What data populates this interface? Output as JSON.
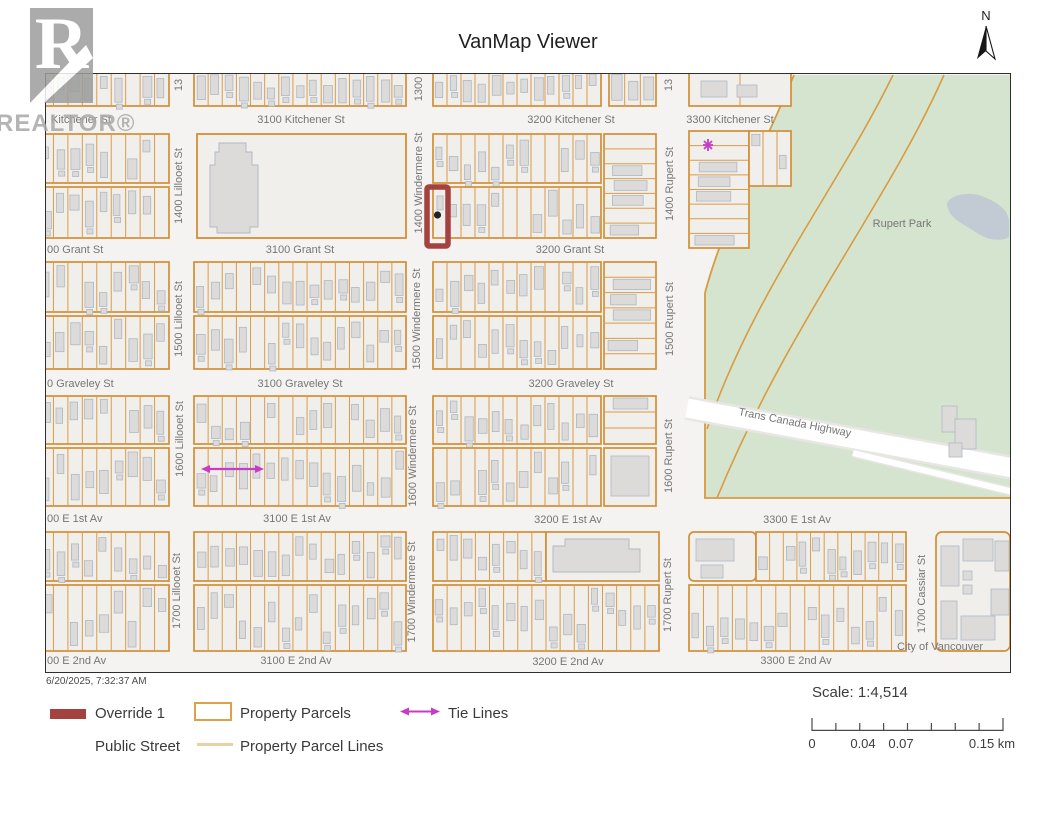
{
  "title": "VanMap Viewer",
  "north": {
    "label": "N"
  },
  "watermark": {
    "letter": "R",
    "name": "REALTOR®"
  },
  "footer": {
    "timestamp": "6/20/2025, 7:32:37 AM",
    "legend": {
      "override_label": "Override 1",
      "property_parcels_label": "Property Parcels",
      "tie_lines_label": "Tie Lines",
      "public_street_label": "Public Street",
      "property_parcel_lines_label": "Property Parcel Lines"
    },
    "scale": {
      "label": "Scale: 1:4,514",
      "tick_labels": [
        "0",
        "0.04",
        "0.07",
        "0.15 km"
      ]
    }
  },
  "colors": {
    "parcel_orange": "#dd9a44",
    "block_outline": "#d28f35",
    "block_fill": "#f1efec",
    "street_bg": "#f4f3f1",
    "override_red": "#a3423f",
    "tie_magenta": "#c73bc7",
    "park_green": "#d5e4cf",
    "park_edge": "#d99b3f",
    "pond_gray": "#c2cbd3",
    "building_fill": "#dcdbda",
    "building_stroke": "#aeb8c3",
    "label_gray": "#767676",
    "legend_line_tan": "#ecd0a4",
    "legend_parcel_border": "#dfa04a"
  },
  "map": {
    "labels": [
      {
        "text": "Kitchener St",
        "x": 50,
        "y": 122,
        "align": "start"
      },
      {
        "text": "3100 Kitchener St",
        "x": 300,
        "y": 122
      },
      {
        "text": "3200 Kitchener St",
        "x": 570,
        "y": 122
      },
      {
        "text": "3300 Kitchener St",
        "x": 729,
        "y": 122
      },
      {
        "text": "00 Grant St",
        "x": 46,
        "y": 252,
        "align": "start"
      },
      {
        "text": "3100 Grant St",
        "x": 299,
        "y": 252
      },
      {
        "text": "3200 Grant St",
        "x": 569,
        "y": 252
      },
      {
        "text": "0 Graveley St",
        "x": 46,
        "y": 386,
        "align": "start"
      },
      {
        "text": "3100 Graveley St",
        "x": 299,
        "y": 386
      },
      {
        "text": "3200 Graveley St",
        "x": 570,
        "y": 386
      },
      {
        "text": "00 E 1st Av",
        "x": 46,
        "y": 521,
        "align": "start"
      },
      {
        "text": "3100 E 1st Av",
        "x": 296,
        "y": 521
      },
      {
        "text": "3200 E 1st Av",
        "x": 567,
        "y": 522
      },
      {
        "text": "3300 E 1st Av",
        "x": 796,
        "y": 522
      },
      {
        "text": "00 E 2nd Av",
        "x": 46,
        "y": 663,
        "align": "start"
      },
      {
        "text": "3100 E 2nd Av",
        "x": 295,
        "y": 663
      },
      {
        "text": "3200 E 2nd Av",
        "x": 567,
        "y": 664
      },
      {
        "text": "3300 E 2nd Av",
        "x": 795,
        "y": 663
      },
      {
        "text": "13",
        "x": 181,
        "y": 84,
        "rot": -90
      },
      {
        "text": "1300",
        "x": 421,
        "y": 88,
        "rot": -90
      },
      {
        "text": "13",
        "x": 671,
        "y": 84,
        "rot": -90
      },
      {
        "text": "1400 Lillooet St",
        "x": 181,
        "y": 185,
        "rot": -90
      },
      {
        "text": "1400 Windermere St",
        "x": 421,
        "y": 182,
        "rot": -90
      },
      {
        "text": "1400 Rupert St",
        "x": 672,
        "y": 183,
        "rot": -90
      },
      {
        "text": "1500 Lillooet St",
        "x": 181,
        "y": 318,
        "rot": -90
      },
      {
        "text": "1500 Windermere St",
        "x": 419,
        "y": 318,
        "rot": -90
      },
      {
        "text": "1500 Rupert St",
        "x": 672,
        "y": 318,
        "rot": -90
      },
      {
        "text": "1600 Lillooet St",
        "x": 182,
        "y": 438,
        "rot": -90
      },
      {
        "text": "1600 Windermere St",
        "x": 415,
        "y": 455,
        "rot": -90
      },
      {
        "text": "1600 Rupert St",
        "x": 671,
        "y": 455,
        "rot": -90
      },
      {
        "text": "1700 Lillooet St",
        "x": 179,
        "y": 590,
        "rot": -90
      },
      {
        "text": "1700 Windermere St",
        "x": 414,
        "y": 591,
        "rot": -90
      },
      {
        "text": "1700 Rupert St",
        "x": 670,
        "y": 594,
        "rot": -90
      },
      {
        "text": "1700 Cassiar St",
        "x": 924,
        "y": 593,
        "rot": -90
      },
      {
        "text": "Rupert Park",
        "x": 901,
        "y": 226
      },
      {
        "text": "Trans Canada Highway",
        "x": 737,
        "y": 414,
        "rot": 11,
        "align": "start"
      },
      {
        "text": "City of Vancouver",
        "x": 939,
        "y": 649
      }
    ],
    "annotations": {
      "override_parcel": {
        "x": 426,
        "y": 186,
        "w": 21,
        "h": 59
      },
      "override_point": {
        "x": 436.5,
        "y": 214
      },
      "tie_arrow": {
        "x1": 200,
        "y1": 468,
        "x2": 263,
        "y2": 468
      },
      "tie_star": {
        "x": 707,
        "y": 144
      }
    }
  }
}
